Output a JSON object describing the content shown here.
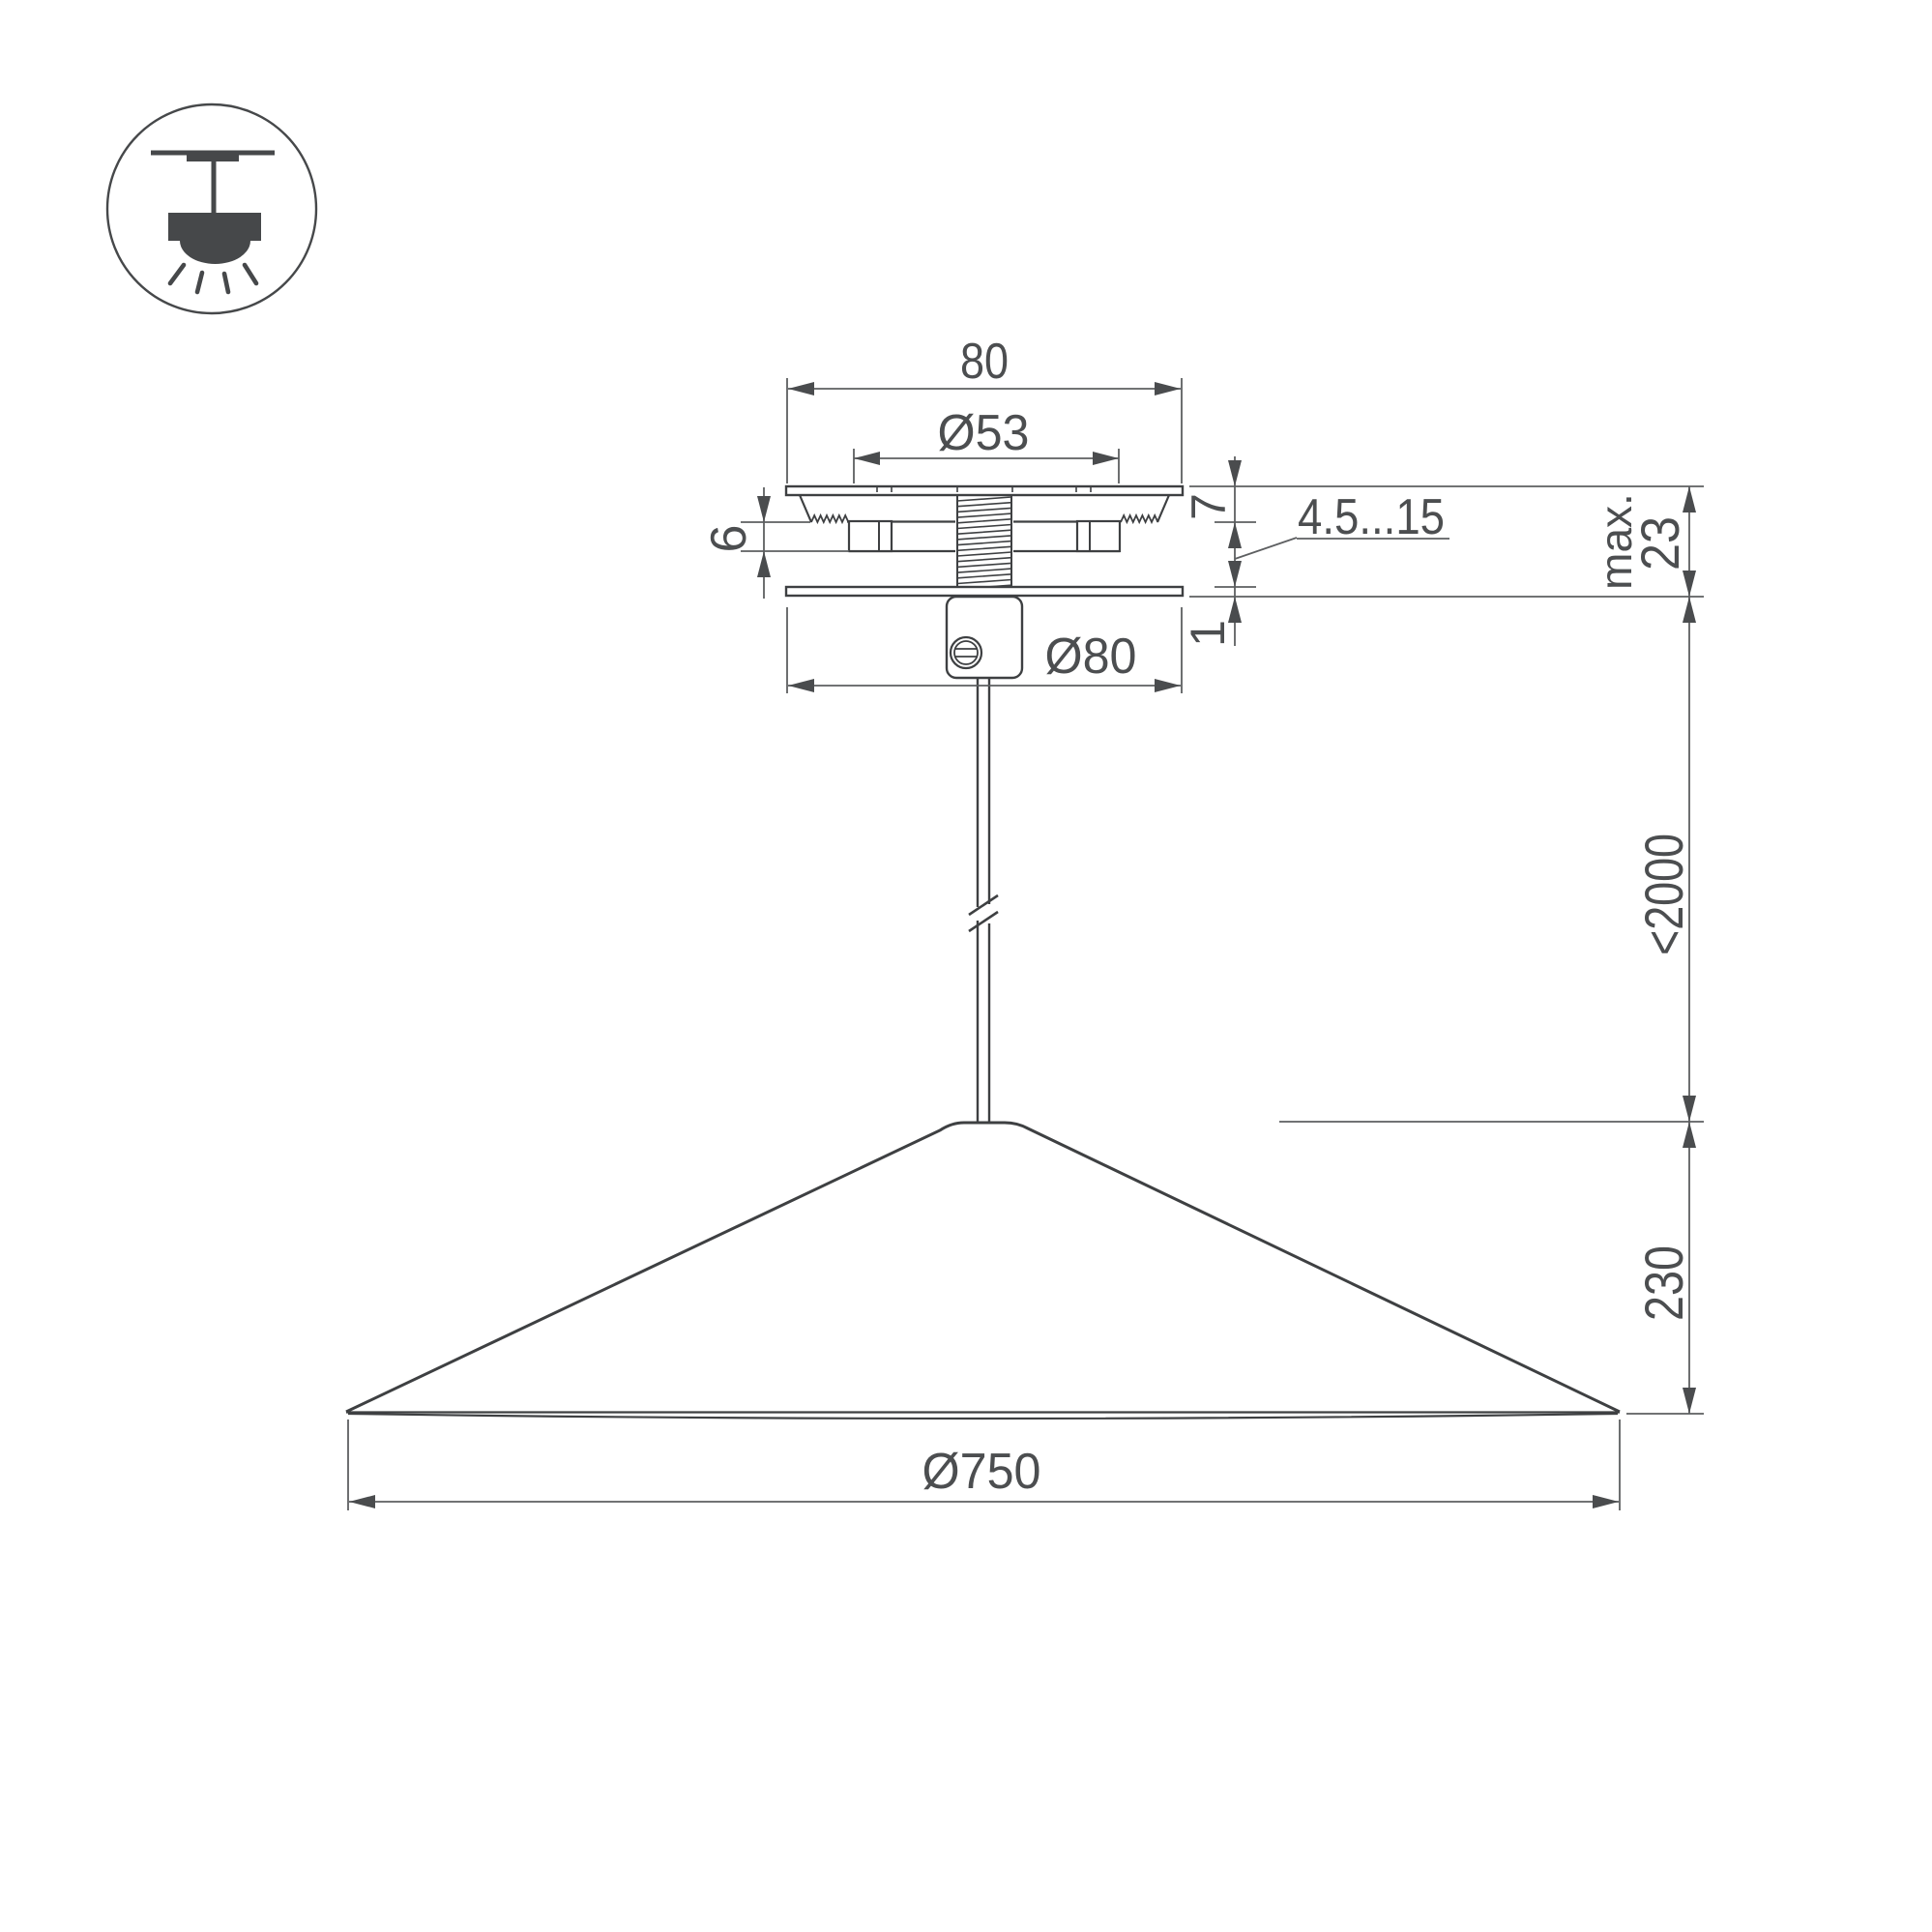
{
  "drawing": {
    "type": "pendant-lamp-technical-drawing",
    "background": "#ffffff",
    "colors": {
      "geometry_line": "#3e4042",
      "dimension_line": "#5d5f61",
      "text": "#4c4e50",
      "icon": "#46484a"
    }
  },
  "icon": {
    "meaning": "ceiling-suspended-lamp-mount"
  },
  "dimensions": {
    "canopy_width": "80",
    "canopy_hole_diameter": "Ø53",
    "canopy_top_height": "7",
    "clamp_height": "6",
    "ceiling_thickness_range": "4.5...15",
    "max_label": "max.",
    "max_total_height": "23",
    "base_plate_thickness": "1",
    "canopy_diameter": "Ø80",
    "suspension_length": "<2000",
    "shade_height": "230",
    "shade_diameter": "Ø750"
  }
}
